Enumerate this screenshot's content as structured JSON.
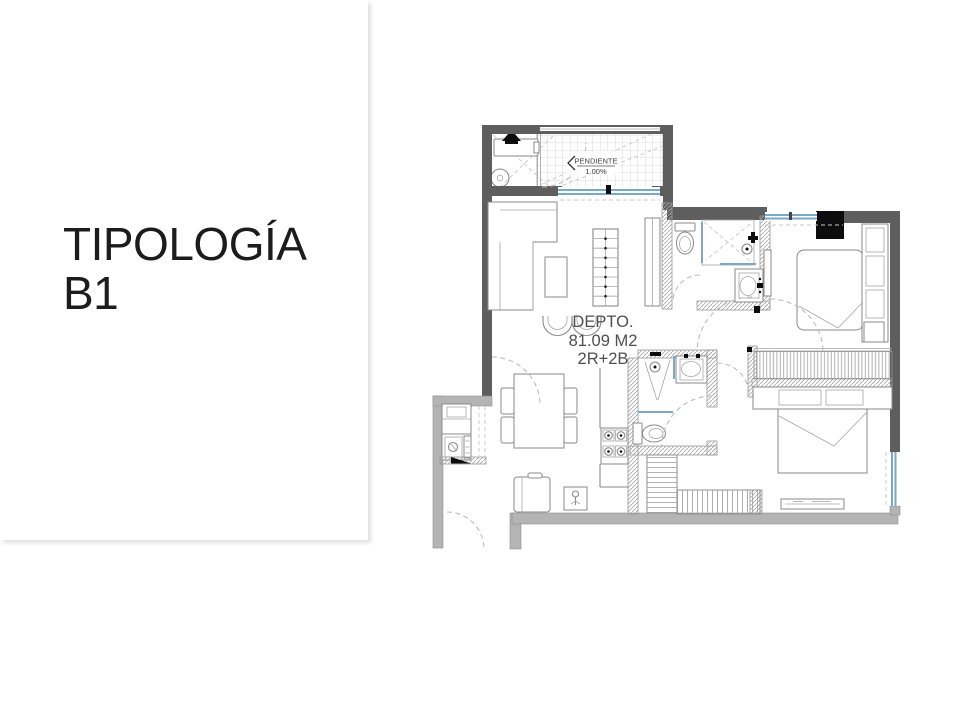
{
  "slide": {
    "title": {
      "line1": "TIPOLOGÍA",
      "line2": "B1"
    }
  },
  "floorplan": {
    "unit_label": {
      "name": "DEPTO.",
      "area": "81.09 M2",
      "config": "2R+2B"
    },
    "slope": {
      "label": "PENDIENTE",
      "value": "1.00%"
    },
    "colors": {
      "wall_dark": "#5e5e5e",
      "wall_light": "#b4b4b4",
      "window_blue": "#7ba7c9",
      "fixture_line": "#8a8a8a",
      "accent_black": "#0d0d0d",
      "label_text": "#4f4f4f"
    }
  }
}
